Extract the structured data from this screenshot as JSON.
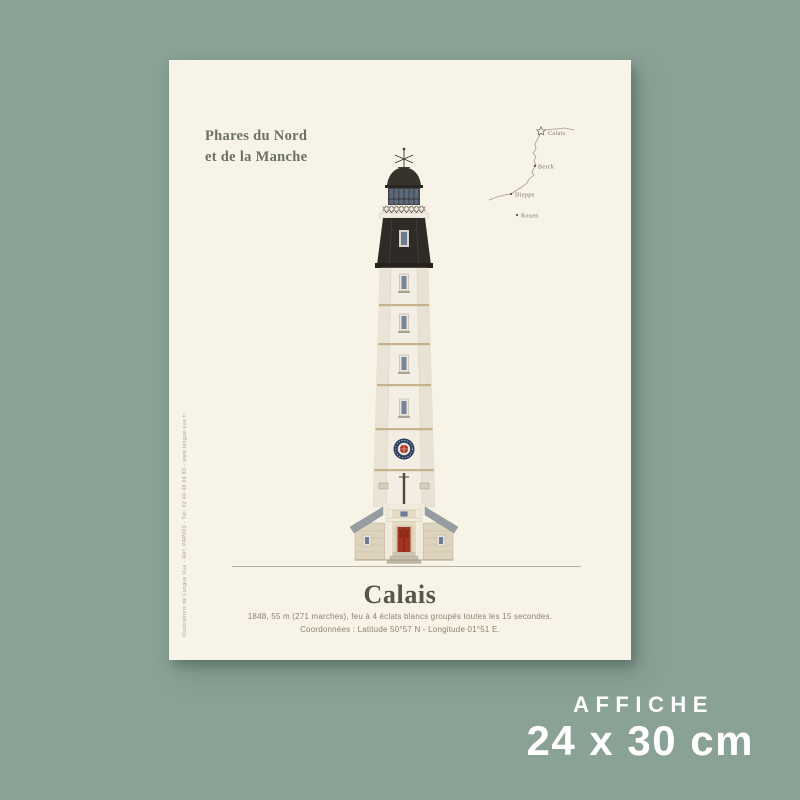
{
  "colors": {
    "background_green": "#8aa196",
    "poster_cream": "#f7f3e6",
    "title_green_gray": "#6b7168",
    "name_dark_gray": "#54554d",
    "description_taupe": "#8d8272",
    "lantern_black": "#2e2a25",
    "door_red": "#a23420",
    "emblem_navy": "#2b3f63",
    "emblem_red": "#b23226",
    "band_beige": "#c6b28b",
    "label_white": "#ffffff"
  },
  "poster": {
    "series_title": {
      "line1": "Phares du Nord",
      "line2": "et de la Manche"
    },
    "map": {
      "locations": [
        {
          "name": "Calais",
          "marker": "star-icon"
        },
        {
          "name": "Berck",
          "marker": "square-dot-icon"
        },
        {
          "name": "Dieppe",
          "marker": "round-dot-icon"
        },
        {
          "name": "Rouen",
          "marker": "round-dot-icon"
        }
      ]
    },
    "title": "Calais",
    "description": {
      "line1": "1848, 55 m (271 marches), feu à 4 éclats blancs groupés toutes les 15 secondes.",
      "line2": "Coordonnées : Latitude 50°57 N - Longitude 01°51 E."
    },
    "credits": "Illustrations de Longue Vue - Réf. PAP003 - Tél. 02 40 48 06 83 - www.longue-vue.fr"
  },
  "product_label": {
    "type": "AFFICHE",
    "dimensions": "24 x 30 cm"
  }
}
